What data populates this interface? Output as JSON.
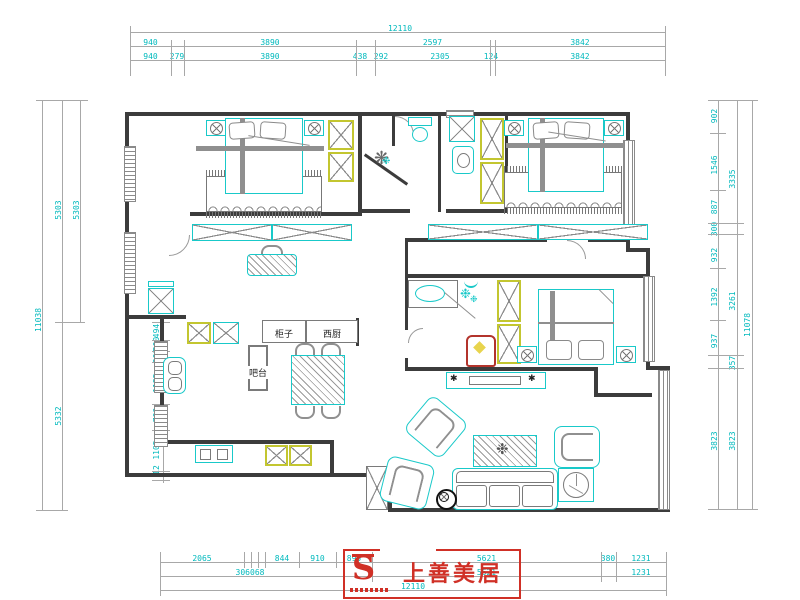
{
  "app": {
    "type": "residential floor plan drawing"
  },
  "colors": {
    "furniture_cyan": "#19c9c9",
    "wardrobe_yellow": "#c3c630",
    "dim_cyan": "#00b9bd",
    "wall": "#3c3c3c",
    "logo_red": "#d03026"
  },
  "icons": {
    "plant": "❋",
    "snowflake": "❉",
    "speaker": "✱",
    "lamp": "⊗"
  },
  "rooms": {
    "cabinet_label": "柜子",
    "west_kitchen_label": "西厨",
    "bar_label": "吧台"
  },
  "logo": {
    "brand": "上善美居",
    "glyph": "S"
  },
  "dims": {
    "top_overall": "12110",
    "top_row1": [
      "940",
      "3890",
      "2597",
      "3842"
    ],
    "top_row2": [
      "940",
      "279",
      "3890",
      "438",
      "292",
      "2305",
      "124",
      "3842"
    ],
    "bottom_row1": [
      "2065",
      "844",
      "910",
      "895",
      "5621",
      "380",
      "1231"
    ],
    "bottom_row2": [
      "306068",
      "5621",
      "1231"
    ],
    "bottom_overall": "12110",
    "left_overall": "11038",
    "left_mid": [
      "5303",
      "5332"
    ],
    "left_inner": [
      "5303"
    ],
    "left_window": [
      "494",
      "300",
      "300",
      "1125",
      "700",
      "1105",
      "12"
    ],
    "right_inner": [
      "902",
      "1546",
      "887",
      "300",
      "932",
      "1392",
      "937",
      "3823"
    ],
    "right_mid": [
      "3335",
      "3261",
      "357",
      "3823"
    ],
    "right_overall": "11078"
  }
}
